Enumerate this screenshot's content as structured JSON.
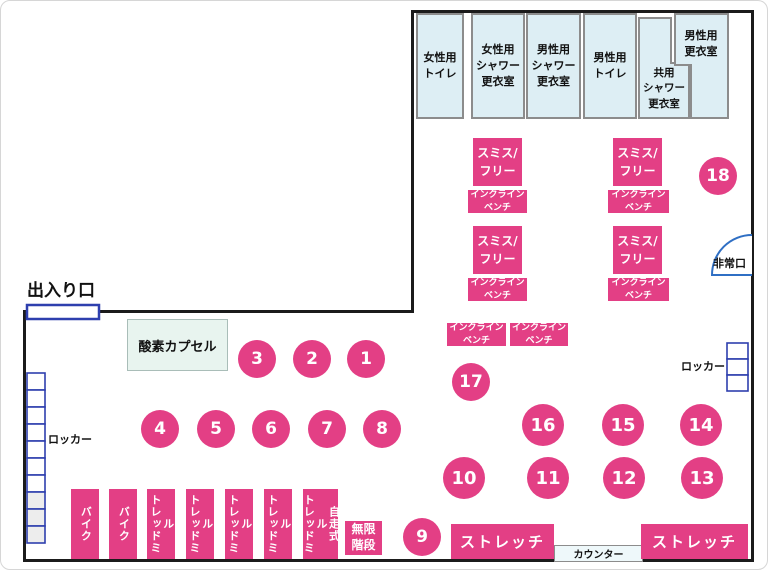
{
  "colors": {
    "pink": "#e33f85",
    "room_fill": "#ddeef4",
    "room_border": "#8c8c8c",
    "wall": "#1b1b1b",
    "locker_blue": "#2e3fae",
    "entrance_door_blue": "#2e3fae",
    "emergency_arc_blue": "#2f6fc4",
    "oxygen_fill": "#e8f4ef",
    "counter_fill": "#eef8fa"
  },
  "rooms": [
    {
      "label": "女性用\nトイレ"
    },
    {
      "label": "女性用\nシャワー\n更衣室"
    },
    {
      "label": "男性用\nシャワー\n更衣室"
    },
    {
      "label": "男性用\nトイレ"
    },
    {
      "label": "共用\nシャワー\n更衣室"
    },
    {
      "label": "男性用\n更衣室"
    }
  ],
  "facilities": {
    "entrance": "出入り口",
    "emergency_exit": "非常口",
    "oxygen_capsule": "酸素カプセル",
    "locker": "ロッカー",
    "counter": "カウンター",
    "stairs": "無限\n階段",
    "stretch": "ストレッチ"
  },
  "equipment": {
    "smith": "スミス/\nフリー",
    "incline_bench": "インクライン\nベンチ",
    "machines": [
      "バイク",
      "バイク",
      "トレッドミル",
      "トレッドミル",
      "トレッドミル",
      "トレッドミル",
      "トレッドミル\n自走式"
    ]
  },
  "circles": [
    "1",
    "2",
    "3",
    "4",
    "5",
    "6",
    "7",
    "8",
    "9",
    "10",
    "11",
    "12",
    "13",
    "14",
    "15",
    "16",
    "17",
    "18"
  ]
}
